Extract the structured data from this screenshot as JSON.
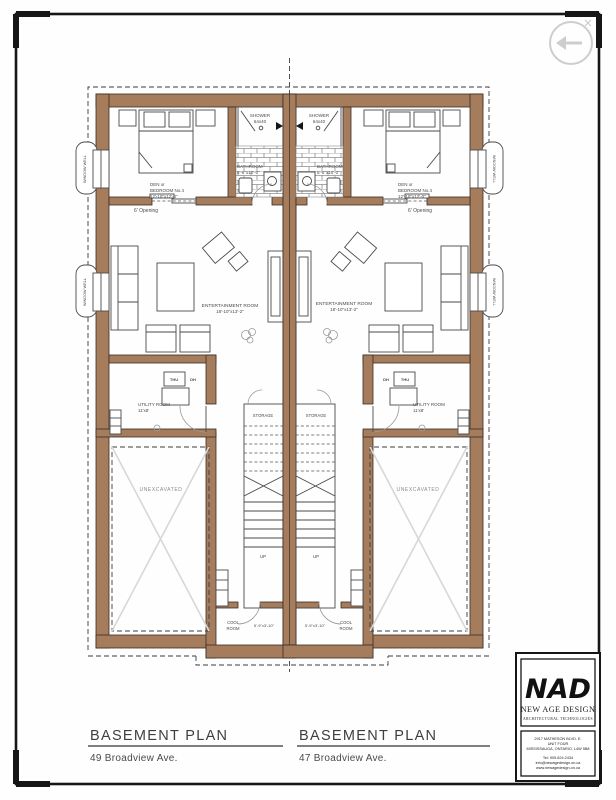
{
  "sheet": {
    "type": "architectural-basement-plan",
    "frame_color": "#161616",
    "wall_color": "#a57c5c",
    "paper_color": "#fefefe"
  },
  "watermark": {
    "icon": "north-arrow-circle-icon",
    "color": "#cdcdcd"
  },
  "rooms": {
    "den": {
      "line1": "DEN or",
      "line2": "BEDROOM No.4",
      "dim": "12'-10\"x12'-0\""
    },
    "shower": {
      "label": "SHOWER",
      "dim": "64x40"
    },
    "bathroom": {
      "label": "BATHROOM",
      "dim": "5'-6\"x10'-0\""
    },
    "entertainment": {
      "label": "ENTERTAINMENT ROOM",
      "dim": "18'-10\"x13'-2\""
    },
    "utility": {
      "label": "UTILITY ROOM",
      "dim": "11'x8'",
      "appliance1": "THU",
      "appliance2": "DH"
    },
    "storage": {
      "label": "STORAGE"
    },
    "stairs": {
      "label": "UP"
    },
    "unexcavated": {
      "label": "UNEXCAVATED"
    },
    "cool": {
      "word1": "COOL",
      "word2": "ROOM",
      "dim": "5'-9\"x3'-10\""
    },
    "window_well": {
      "label": "WINDOW WELL"
    },
    "opening": {
      "label": "6' Opening"
    }
  },
  "titles": {
    "left": {
      "title": "BASEMENT PLAN",
      "address": "49 Broadview Ave."
    },
    "right": {
      "title": "BASEMENT PLAN",
      "address": "47 Broadview Ave."
    }
  },
  "title_block": {
    "logo": "NAD",
    "company": "NEW AGE DESIGN",
    "tagline": "ARCHITECTURAL TECHNOLOGIES",
    "addr1": "2917 MATHESON BLVD. E.",
    "addr2": "UNIT FOUR",
    "addr3": "MISSISSAUGA, ONTARIO, L4W 5B8",
    "tel": "Tel: 905.624.2434",
    "email": "info@newagedesign.on.ca",
    "web": "www.newagedesign.on.ca"
  }
}
